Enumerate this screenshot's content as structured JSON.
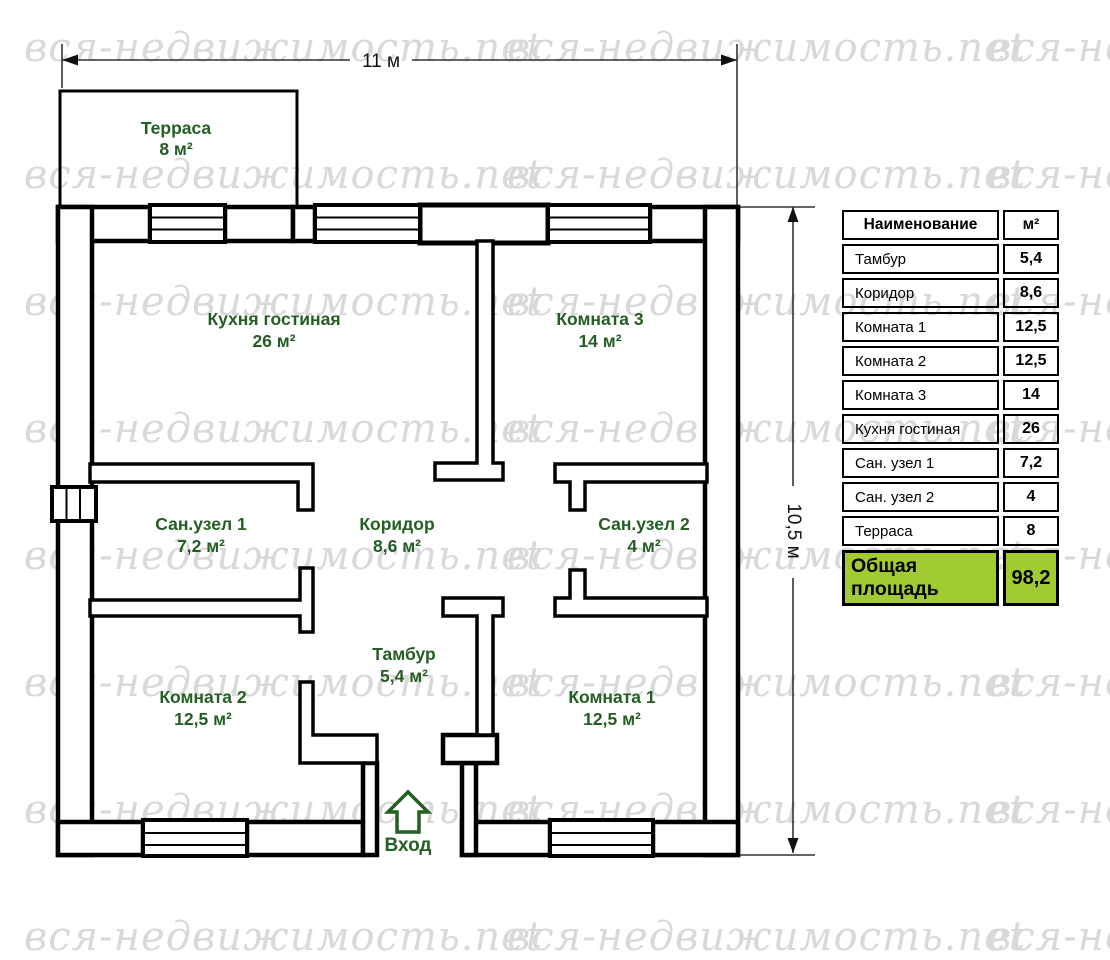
{
  "watermark": {
    "text": "вся-недвижимость.net"
  },
  "dimensions": {
    "width_label": "11 м",
    "height_label": "10,5 м"
  },
  "plan": {
    "rooms": [
      {
        "name": "Терраса",
        "area": "8 м²"
      },
      {
        "name": "Кухня гостиная",
        "area": "26 м²"
      },
      {
        "name": "Комната 3",
        "area": "14 м²"
      },
      {
        "name": "Сан.узел 1",
        "area": "7,2 м²"
      },
      {
        "name": "Коридор",
        "area": "8,6 м²"
      },
      {
        "name": "Сан.узел 2",
        "area": "4 м²"
      },
      {
        "name": "Комната 2",
        "area": "12,5 м²"
      },
      {
        "name": "Тамбур",
        "area": "5,4 м²"
      },
      {
        "name": "Комната 1",
        "area": "12,5 м²"
      }
    ],
    "entrance_label": "Вход"
  },
  "area_table": {
    "header": {
      "name": "Наименование",
      "area": "м²"
    },
    "rows": [
      {
        "name": "Тамбур",
        "area": "5,4"
      },
      {
        "name": "Коридор",
        "area": "8,6"
      },
      {
        "name": "Комната 1",
        "area": "12,5"
      },
      {
        "name": "Комната 2",
        "area": "12,5"
      },
      {
        "name": "Комната 3",
        "area": "14"
      },
      {
        "name": "Кухня гостиная",
        "area": "26"
      },
      {
        "name": "Сан. узел 1",
        "area": "7,2"
      },
      {
        "name": "Сан. узел 2",
        "area": "4"
      },
      {
        "name": "Терраса",
        "area": "8"
      }
    ],
    "total": {
      "name": "Общая площадь",
      "area": "98,2"
    }
  },
  "colors": {
    "room_label_green": "#235e23",
    "total_row_green": "#a2ca33",
    "watermark_gray": "#d9d9d9",
    "wall_black": "#000000"
  }
}
